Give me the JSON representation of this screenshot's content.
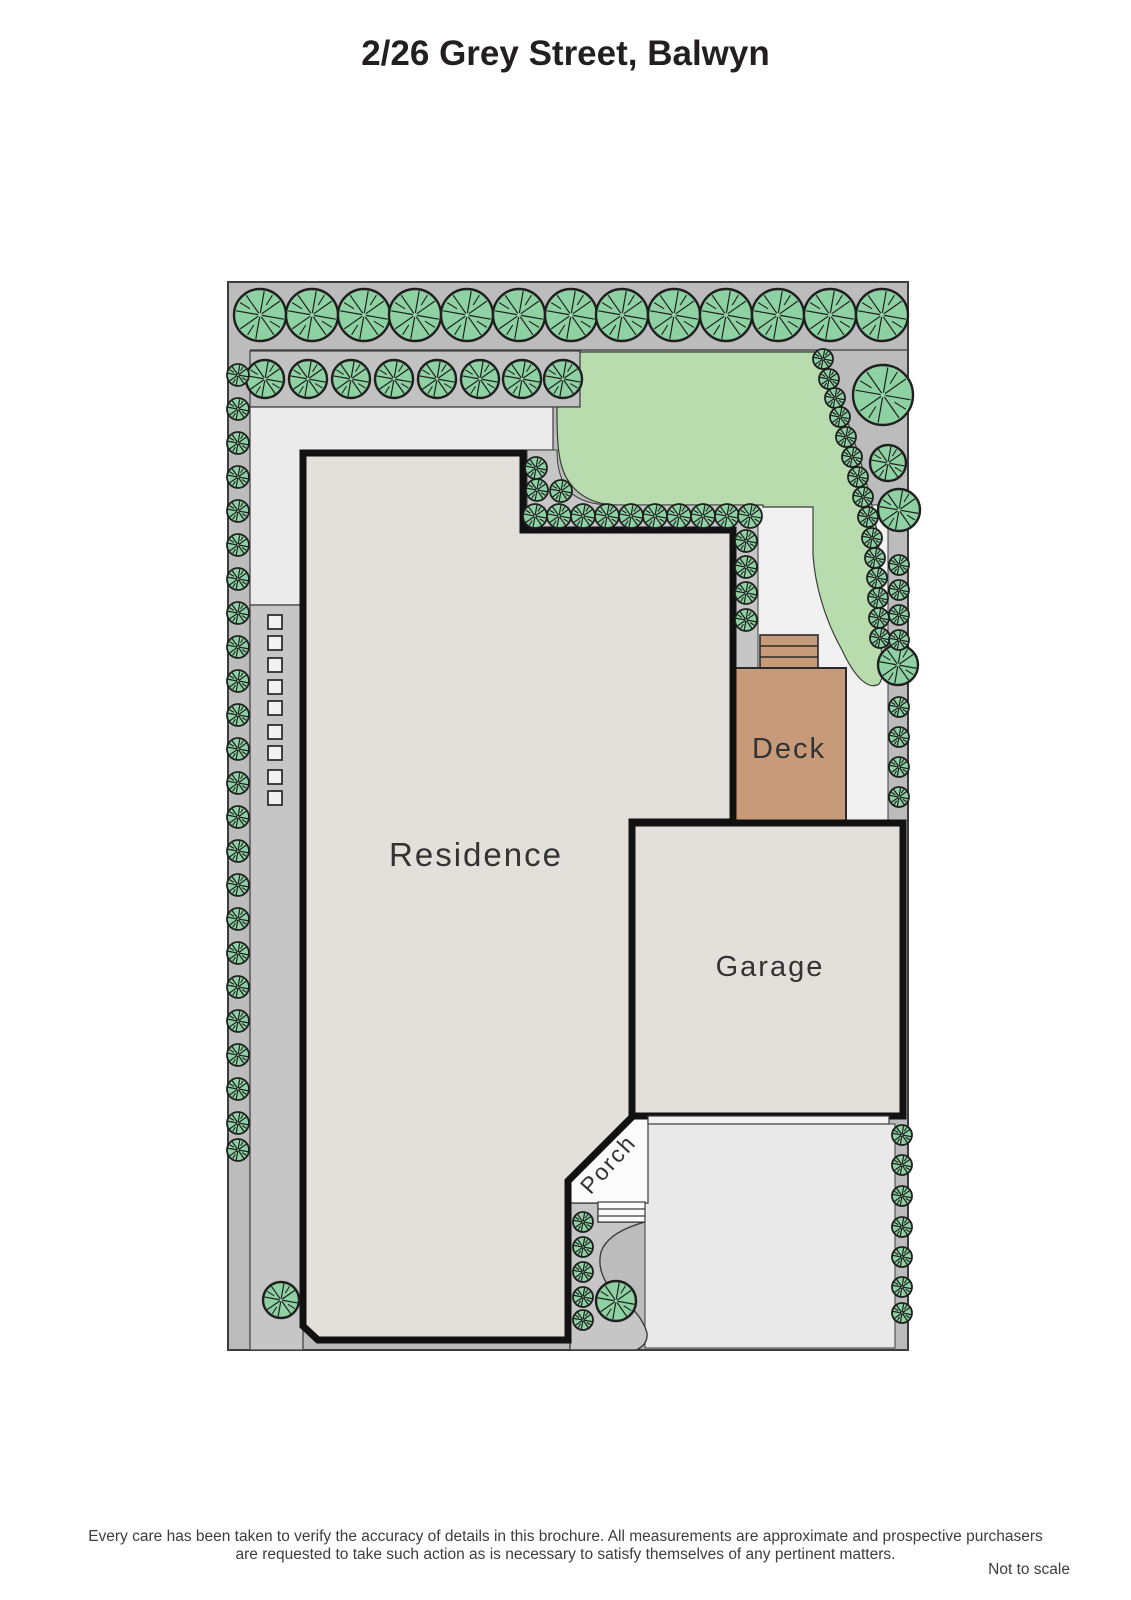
{
  "page": {
    "title": "2/26 Grey Street, Balwyn"
  },
  "plan": {
    "labels": {
      "residence": "Residence",
      "garage": "Garage",
      "deck": "Deck",
      "porch": "Porch"
    },
    "colors": {
      "lawn": "#b9dcae",
      "foliage": "#8ed2a3",
      "foliage_outline": "#1f1f1f",
      "deck": "#c79b79",
      "building_fill": "#e3dfda",
      "wall": "#111111",
      "paving_light": "#ebebeb",
      "paving_mid": "#c6c6c6",
      "site_gray": "#bcbcbc",
      "walkway": "#f1f1f1",
      "porch_white": "#fbfbfb",
      "driveway": "#e9e9e9",
      "stone": "#f2f2f2"
    },
    "trees": [
      [
        260,
        315,
        26
      ],
      [
        312,
        315,
        26
      ],
      [
        364,
        315,
        26
      ],
      [
        415,
        315,
        26
      ],
      [
        467,
        315,
        26
      ],
      [
        519,
        315,
        26
      ],
      [
        571,
        315,
        26
      ],
      [
        622,
        315,
        26
      ],
      [
        674,
        315,
        26
      ],
      [
        726,
        315,
        26
      ],
      [
        778,
        315,
        26
      ],
      [
        830,
        315,
        26
      ],
      [
        882,
        315,
        26
      ],
      [
        265,
        379,
        19
      ],
      [
        308,
        379,
        19
      ],
      [
        351,
        379,
        19
      ],
      [
        394,
        379,
        19
      ],
      [
        437,
        379,
        19
      ],
      [
        480,
        379,
        19
      ],
      [
        522,
        379,
        19
      ],
      [
        563,
        379,
        19
      ],
      [
        238,
        375,
        11
      ],
      [
        238,
        409,
        11
      ],
      [
        238,
        443,
        11
      ],
      [
        238,
        477,
        11
      ],
      [
        238,
        511,
        11
      ],
      [
        238,
        545,
        11
      ],
      [
        238,
        579,
        11
      ],
      [
        238,
        613,
        11
      ],
      [
        238,
        647,
        11
      ],
      [
        238,
        681,
        11
      ],
      [
        238,
        715,
        11
      ],
      [
        238,
        749,
        11
      ],
      [
        238,
        783,
        11
      ],
      [
        238,
        817,
        11
      ],
      [
        238,
        851,
        11
      ],
      [
        238,
        885,
        11
      ],
      [
        238,
        919,
        11
      ],
      [
        238,
        953,
        11
      ],
      [
        238,
        987,
        11
      ],
      [
        238,
        1021,
        11
      ],
      [
        238,
        1055,
        11
      ],
      [
        238,
        1089,
        11
      ],
      [
        238,
        1123,
        11
      ],
      [
        238,
        1150,
        11
      ],
      [
        536,
        468,
        11
      ],
      [
        537,
        490,
        11
      ],
      [
        561,
        491,
        11
      ],
      [
        535,
        516,
        12
      ],
      [
        559,
        516,
        12
      ],
      [
        583,
        516,
        12
      ],
      [
        607,
        516,
        12
      ],
      [
        631,
        516,
        12
      ],
      [
        655,
        516,
        12
      ],
      [
        679,
        516,
        12
      ],
      [
        703,
        516,
        12
      ],
      [
        727,
        516,
        12
      ],
      [
        750,
        516,
        12
      ],
      [
        746,
        541,
        11
      ],
      [
        746,
        567,
        11
      ],
      [
        746,
        593,
        11
      ],
      [
        746,
        620,
        11
      ],
      [
        823,
        359,
        10
      ],
      [
        829,
        379,
        10
      ],
      [
        835,
        398,
        10
      ],
      [
        840,
        417,
        10
      ],
      [
        846,
        437,
        10
      ],
      [
        852,
        457,
        10
      ],
      [
        858,
        477,
        10
      ],
      [
        863,
        497,
        10
      ],
      [
        868,
        517,
        10
      ],
      [
        872,
        538,
        10
      ],
      [
        875,
        558,
        10
      ],
      [
        877,
        578,
        10
      ],
      [
        878,
        598,
        10
      ],
      [
        879,
        618,
        10
      ],
      [
        880,
        638,
        10
      ],
      [
        883,
        395,
        30
      ],
      [
        888,
        463,
        18
      ],
      [
        899,
        510,
        21
      ],
      [
        898,
        665,
        20
      ],
      [
        899,
        565,
        10
      ],
      [
        899,
        590,
        10
      ],
      [
        899,
        615,
        10
      ],
      [
        899,
        640,
        10
      ],
      [
        899,
        707,
        10
      ],
      [
        899,
        737,
        10
      ],
      [
        899,
        767,
        10
      ],
      [
        899,
        797,
        10
      ],
      [
        902,
        1135,
        10
      ],
      [
        902,
        1165,
        10
      ],
      [
        902,
        1196,
        10
      ],
      [
        902,
        1227,
        10
      ],
      [
        902,
        1257,
        10
      ],
      [
        902,
        1287,
        10
      ],
      [
        902,
        1313,
        10
      ],
      [
        583,
        1222,
        10
      ],
      [
        583,
        1247,
        10
      ],
      [
        583,
        1272,
        10
      ],
      [
        583,
        1297,
        10
      ],
      [
        583,
        1320,
        10
      ],
      [
        616,
        1301,
        20
      ],
      [
        281,
        1300,
        18
      ]
    ],
    "stones": {
      "x": 275,
      "size": 14,
      "ys": [
        622,
        643,
        665,
        687,
        708,
        732,
        753,
        777,
        798
      ]
    }
  },
  "footer": {
    "disclaimer_line1": "Every care has been taken to verify the accuracy of details in this brochure.  All measurements are approximate and prospective purchasers",
    "disclaimer_line2": "are requested to take such action as is necessary to satisfy themselves of any pertinent matters.",
    "scale_note": "Not to scale"
  }
}
